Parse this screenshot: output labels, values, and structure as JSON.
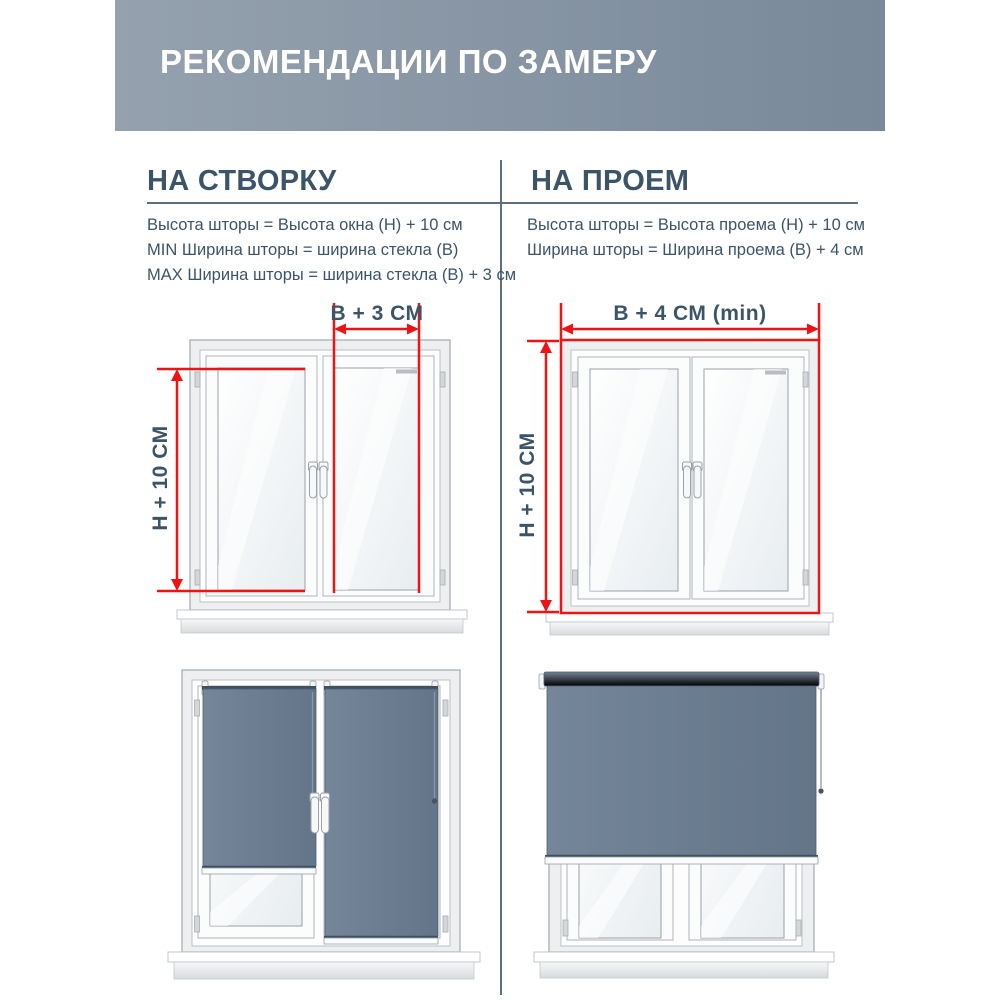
{
  "header": {
    "title": "РЕКОМЕНДАЦИИ ПО ЗАМЕРУ"
  },
  "sections": [
    {
      "heading": "НА СТВОРКУ",
      "lines": [
        "Высота шторы = Высота окна (Н) + 10 см",
        "MIN Ширина шторы = ширина стекла (В)",
        "MAX Ширина шторы = ширина стекла (В) + 3 см"
      ]
    },
    {
      "heading": "НА ПРОЕМ",
      "lines": [
        "Высота шторы = Высота проема (Н) + 10 см",
        "Ширина шторы = Ширина проема (В) + 4 см"
      ]
    }
  ],
  "diagrams": {
    "sash": {
      "width_label": "В + 3 СМ",
      "height_label": "Н + 10 СМ"
    },
    "opening": {
      "width_label": "В + 4 СМ (min)",
      "height_label": "Н + 10 СМ"
    }
  },
  "colors": {
    "accent_red": "#ee1414",
    "text_slate": "#3b5468",
    "divider": "#5c6f80",
    "header_bg_left": "#95a1ae",
    "header_bg_right": "#79899a",
    "blind_fabric": "#6b7d90",
    "blind_roller": "#5d7082"
  }
}
